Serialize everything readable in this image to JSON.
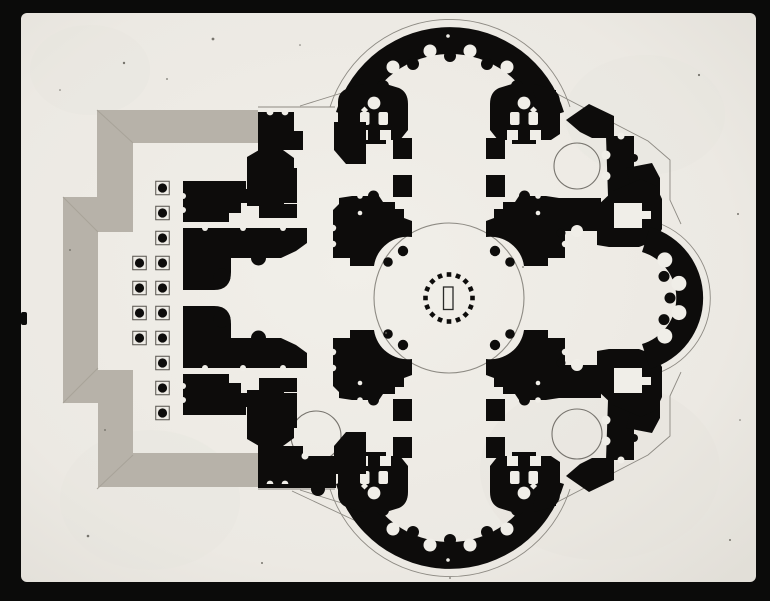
{
  "colors": {
    "frame": "#0B0B0A",
    "paper": "#ECE9E3",
    "paper_bright": "#F0EEE8",
    "paper_edge": "#E2DFD8",
    "shade_gray": "#B7B2A9",
    "shade_gray_dark": "#A8A399",
    "ink": "#0D0C0B",
    "line": "#8D8A83",
    "speck": "#5A5850"
  },
  "frame": {
    "left": 21,
    "top": 13,
    "right": 756,
    "bottom": 582,
    "corner_radius": 6
  },
  "plan": {
    "center": {
      "x": 449,
      "y": 298
    },
    "dome": {
      "radius": 75,
      "ring_radius": 23.5,
      "ring_column_count": 16,
      "ring_column_size": 4.6,
      "altar_rect": {
        "x": 443.5,
        "y": 287,
        "w": 9.5,
        "h": 22.5
      }
    },
    "colonnade": {
      "square_size": 13.5,
      "dot_radius": 4.6,
      "columns": [
        {
          "x": 162.5,
          "rows": [
            188,
            213,
            238,
            263,
            288,
            313,
            338,
            363,
            388,
            413
          ]
        },
        {
          "x": 139.5,
          "rows": [
            263,
            288,
            313,
            338
          ]
        }
      ]
    },
    "corner_chapel_circles": [
      {
        "x": 577,
        "y": 166,
        "r": 23
      },
      {
        "x": 577,
        "y": 434,
        "r": 25
      },
      {
        "x": 316,
        "y": 436,
        "r": 25
      }
    ],
    "stair_towers": [
      {
        "x": 374,
        "y": 103
      },
      {
        "x": 524,
        "y": 103
      },
      {
        "x": 374,
        "y": 493
      },
      {
        "x": 524,
        "y": 493
      }
    ]
  },
  "specks": [
    [
      124,
      63,
      1.2
    ],
    [
      213,
      39,
      1.4
    ],
    [
      167,
      79,
      0.9
    ],
    [
      699,
      75,
      1.1
    ],
    [
      738,
      214,
      1.0
    ],
    [
      88,
      536,
      1.3
    ],
    [
      386,
      333,
      1.2
    ],
    [
      523,
      267,
      0.9
    ],
    [
      262,
      563,
      1.0
    ],
    [
      60,
      90,
      0.8
    ],
    [
      450,
      578,
      0.9
    ],
    [
      730,
      540,
      1.0
    ],
    [
      70,
      250,
      0.9
    ],
    [
      740,
      420,
      0.8
    ],
    [
      105,
      430,
      0.9
    ],
    [
      300,
      45,
      0.8
    ]
  ]
}
